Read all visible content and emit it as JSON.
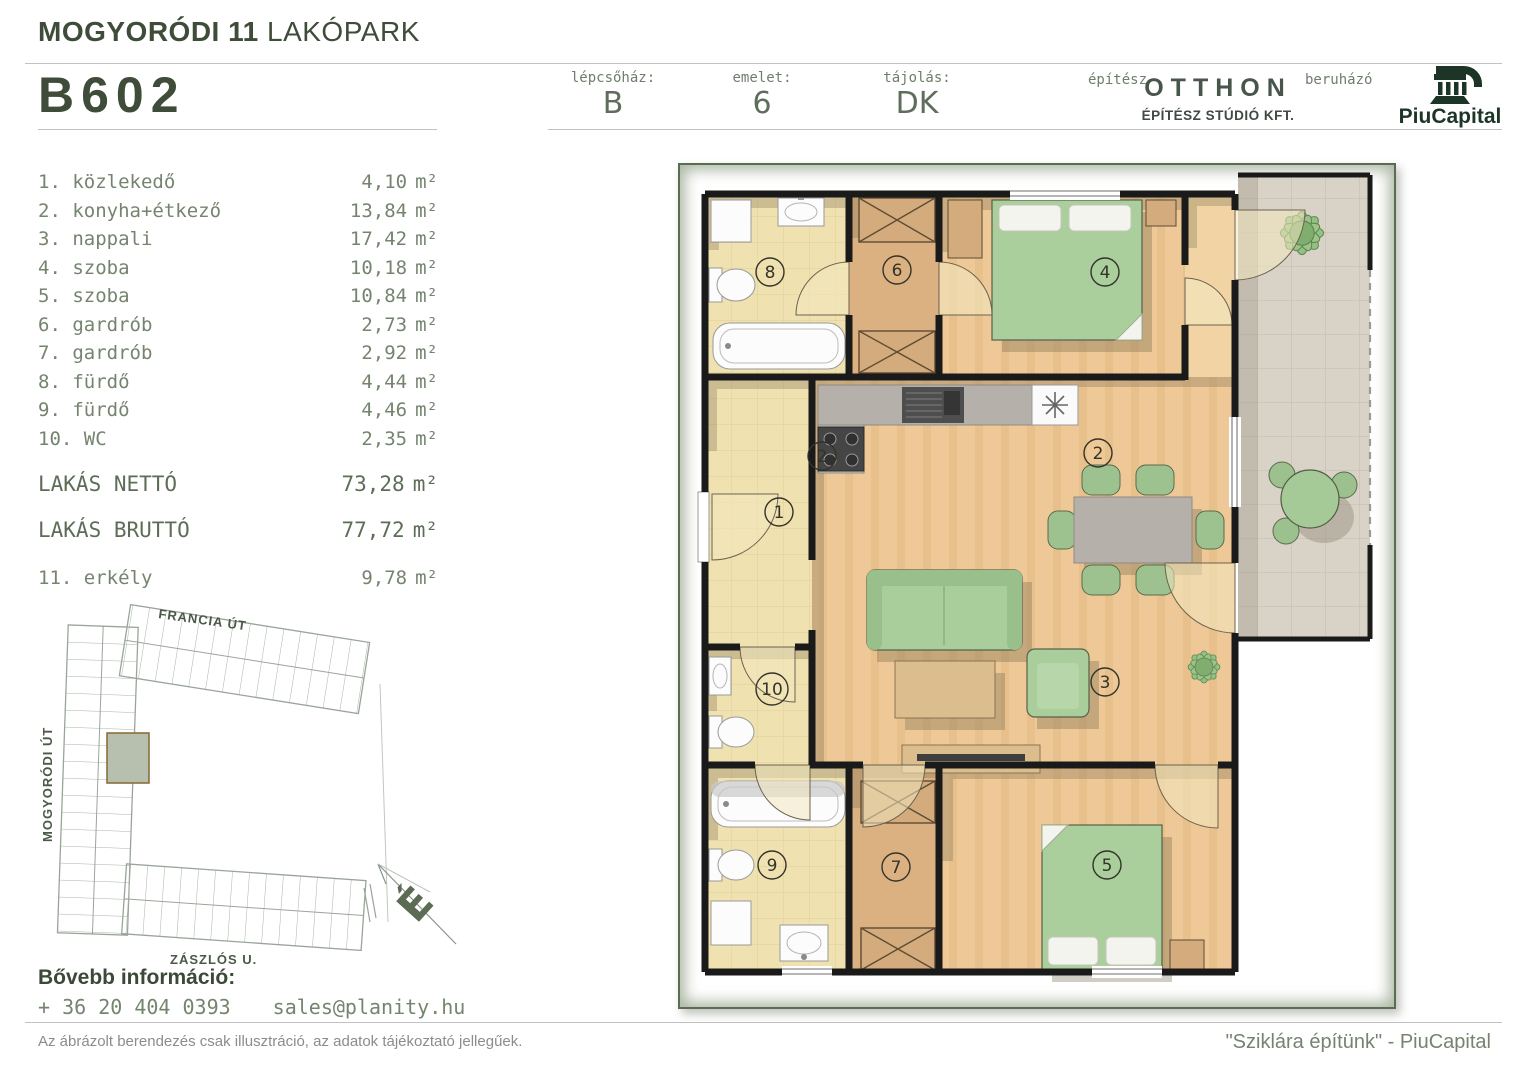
{
  "header": {
    "project_bold": "MOGYORÓDI 11",
    "project_light": "LAKÓPARK",
    "unit_code": "B602",
    "info": [
      {
        "label": "lépcsőház:",
        "value": "B"
      },
      {
        "label": "emelet:",
        "value": "6"
      },
      {
        "label": "tájolás:",
        "value": "DK"
      }
    ],
    "architect_label": "építész",
    "architect_name": "OTTHON",
    "architect_sub": "ÉPÍTÉSZ STÚDIÓ KFT.",
    "developer_label": "beruházó",
    "developer_name": "PiuCapital"
  },
  "rooms": [
    {
      "label": "1. közlekedő",
      "area": "4,10"
    },
    {
      "label": "2. konyha+étkező",
      "area": "13,84"
    },
    {
      "label": "3. nappali",
      "area": "17,42"
    },
    {
      "label": "4. szoba",
      "area": "10,18"
    },
    {
      "label": "5. szoba",
      "area": "10,84"
    },
    {
      "label": "6. gardrób",
      "area": "2,73"
    },
    {
      "label": "7. gardrób",
      "area": "2,92"
    },
    {
      "label": "8. fürdő",
      "area": "4,44"
    },
    {
      "label": "9. fürdő",
      "area": "4,46"
    },
    {
      "label": "10. WC",
      "area": "2,35"
    }
  ],
  "units": {
    "area": "m²"
  },
  "totals": {
    "net_label": "LAKÁS NETTÓ",
    "net_area": "73,28",
    "gross_label": "LAKÁS BRUTTÓ",
    "gross_area": "77,72"
  },
  "balcony_row": {
    "label": "11. erkély",
    "area": "9,78"
  },
  "site_plan": {
    "street_top": "FRANCIA ÚT",
    "street_left": "MOGYORÓDI ÚT",
    "street_bottom": "ZÁSZLÓS U.",
    "north_letter": "É"
  },
  "plan": {
    "labels": [
      "1",
      "2",
      "2",
      "3",
      "4",
      "5",
      "6",
      "7",
      "8",
      "9",
      "10"
    ]
  },
  "contact": {
    "heading": "Bővebb információ:",
    "phone": "+ 36 20 404 0393",
    "email": "sales@planity.hu"
  },
  "footer": {
    "disclaimer": "Az ábrázolt berendezés csak illusztráció, az adatok tájékoztató jellegűek.",
    "slogan": "\"Sziklára építünk\" - PiuCapital"
  },
  "colors": {
    "brand_dark": "#3e4c39",
    "text_green": "#75846f",
    "furniture_green": "#a9cd9b",
    "wood_floor": "#eec896",
    "tile_floor": "#f0e2b0",
    "balcony_tile": "#d9d2c6",
    "wall": "#1a1a1a"
  }
}
